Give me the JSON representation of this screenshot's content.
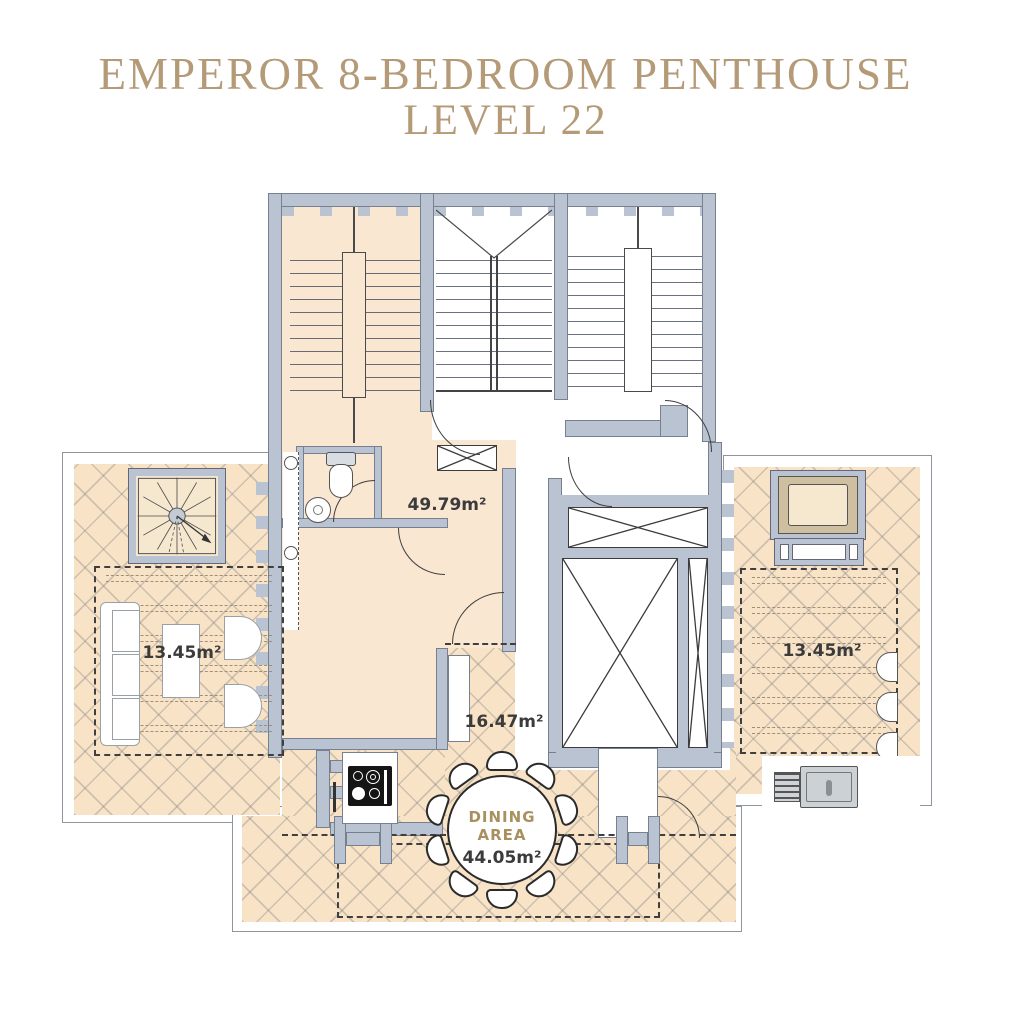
{
  "title": {
    "line1": "EMPEROR 8-BEDROOM PENTHOUSE",
    "line2": "LEVEL 22"
  },
  "areas": {
    "main_room": "49.79m²",
    "left_terrace": "13.45m²",
    "right_terrace": "13.45m²",
    "middle_terrace": "16.47m²",
    "dining_label_line1": "DINING",
    "dining_label_line2": "AREA",
    "dining_area": "44.05m²"
  },
  "colors": {
    "accent_gold": "#b49a77",
    "wall": "#b9c3d1",
    "floor_fill": "#f9e7d1",
    "terrace_fill": "#f8e3c6"
  }
}
